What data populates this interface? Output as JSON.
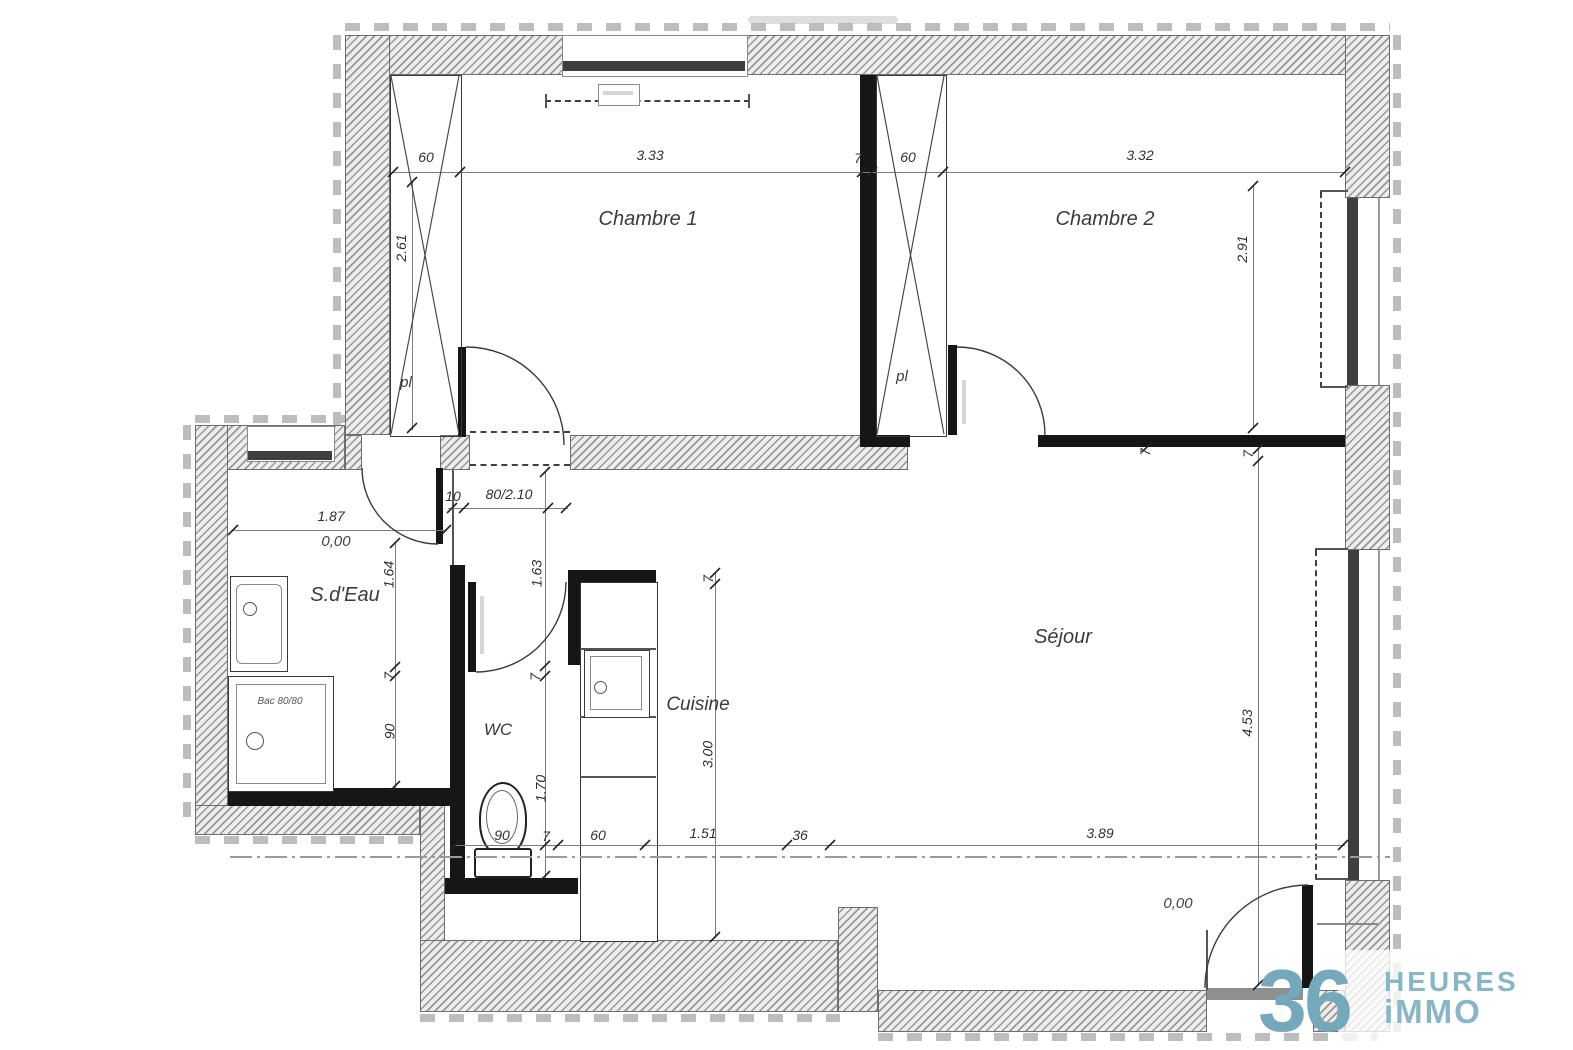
{
  "rooms": {
    "chambre1": "Chambre 1",
    "chambre2": "Chambre 2",
    "sejour": "Séjour",
    "cuisine": "Cuisine",
    "wc": "WC",
    "sdeau": "S.d'Eau",
    "closet1": "pl",
    "closet2": "pl"
  },
  "fixtures": {
    "shower": "Bac 80/80"
  },
  "levels": {
    "sdeau": "0,00",
    "entrance": "0,00"
  },
  "dims": {
    "top": {
      "closet1_w": "60",
      "chambre1_w": "3.33",
      "wall": "7",
      "closet2_w": "60",
      "chambre2_w": "3.32"
    },
    "vertical": {
      "closet1_h": "2.61",
      "chambre2_h": "2.91",
      "sejour_wall": "7",
      "sejour_h": "4.53",
      "chambre2_wall": "7"
    },
    "hall": {
      "gap": "10",
      "door": "80/2.10",
      "len1": "1.63",
      "wall1": "7",
      "wc_len": "1.70",
      "sdeau_len": "1.64",
      "sdeau_wall": "7",
      "shower_w": "90",
      "sdeau_w": "1.87"
    },
    "cuisine": {
      "wall": "7",
      "depth": "3.00"
    },
    "bottom": {
      "wc_w": "90",
      "wall": "7",
      "counter": "60",
      "kitchen_w": "1.51",
      "step": "36",
      "sejour_w": "3.89"
    }
  },
  "logo": {
    "number": "36",
    "word1": "HEURES",
    "word2": "iMMO"
  },
  "colors": {
    "logo_number": "#73a9bb",
    "logo_text": "#87b7c6"
  }
}
